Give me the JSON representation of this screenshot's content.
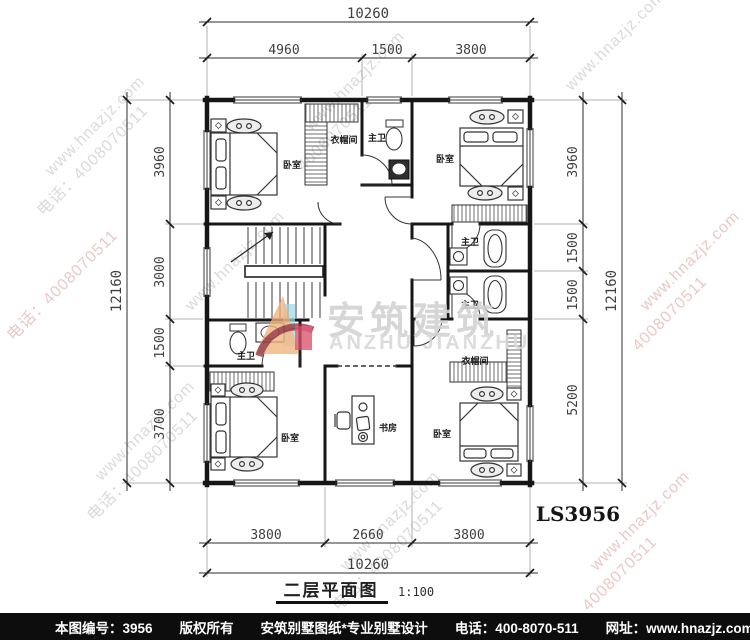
{
  "plan": {
    "title": "二层平面图",
    "scale": "1:100",
    "code": "LS3956",
    "rooms": {
      "bedroom": "卧室",
      "master_bath": "主卫",
      "cloakroom": "衣帽间",
      "study": "书房"
    }
  },
  "dims": {
    "top": {
      "total": "10260",
      "seg": [
        "4960",
        "1500",
        "3800"
      ]
    },
    "bottom": {
      "total": "10260",
      "seg": [
        "3800",
        "2660",
        "3800"
      ]
    },
    "left": {
      "total": "12160",
      "seg": [
        "3960",
        "3000",
        "1500",
        "3700"
      ]
    },
    "right": {
      "total": "12160",
      "seg": [
        "3960",
        "1500",
        "1500",
        "5200"
      ]
    }
  },
  "logo": {
    "cn": "安筑建筑",
    "en": "ANZHU JIANZHU"
  },
  "watermark": {
    "site": "www.hnazjz.com",
    "phone": "电话：4008070511",
    "phone_short": "4008070511"
  },
  "footer": {
    "sheet": "本图编号：3956",
    "rights": "版权所有",
    "brand": "安筑别墅图纸*专业别墅设计",
    "phone": "电话：400-8070-511",
    "web": "网址：www.hnazjz.com"
  },
  "colors": {
    "wall": "#161616",
    "dim_text": "#3f3f3f",
    "watermark_gray": "#dadada",
    "watermark_pink": "#eac8c8",
    "logo_gray": "#d2d2d2",
    "logo_orange": "#f2b079",
    "logo_maroon": "#8d2f3e",
    "logo_blue": "#9fd8ea",
    "logo_crimson": "#d94f6a",
    "footer_bg": "#0d0d0d"
  }
}
